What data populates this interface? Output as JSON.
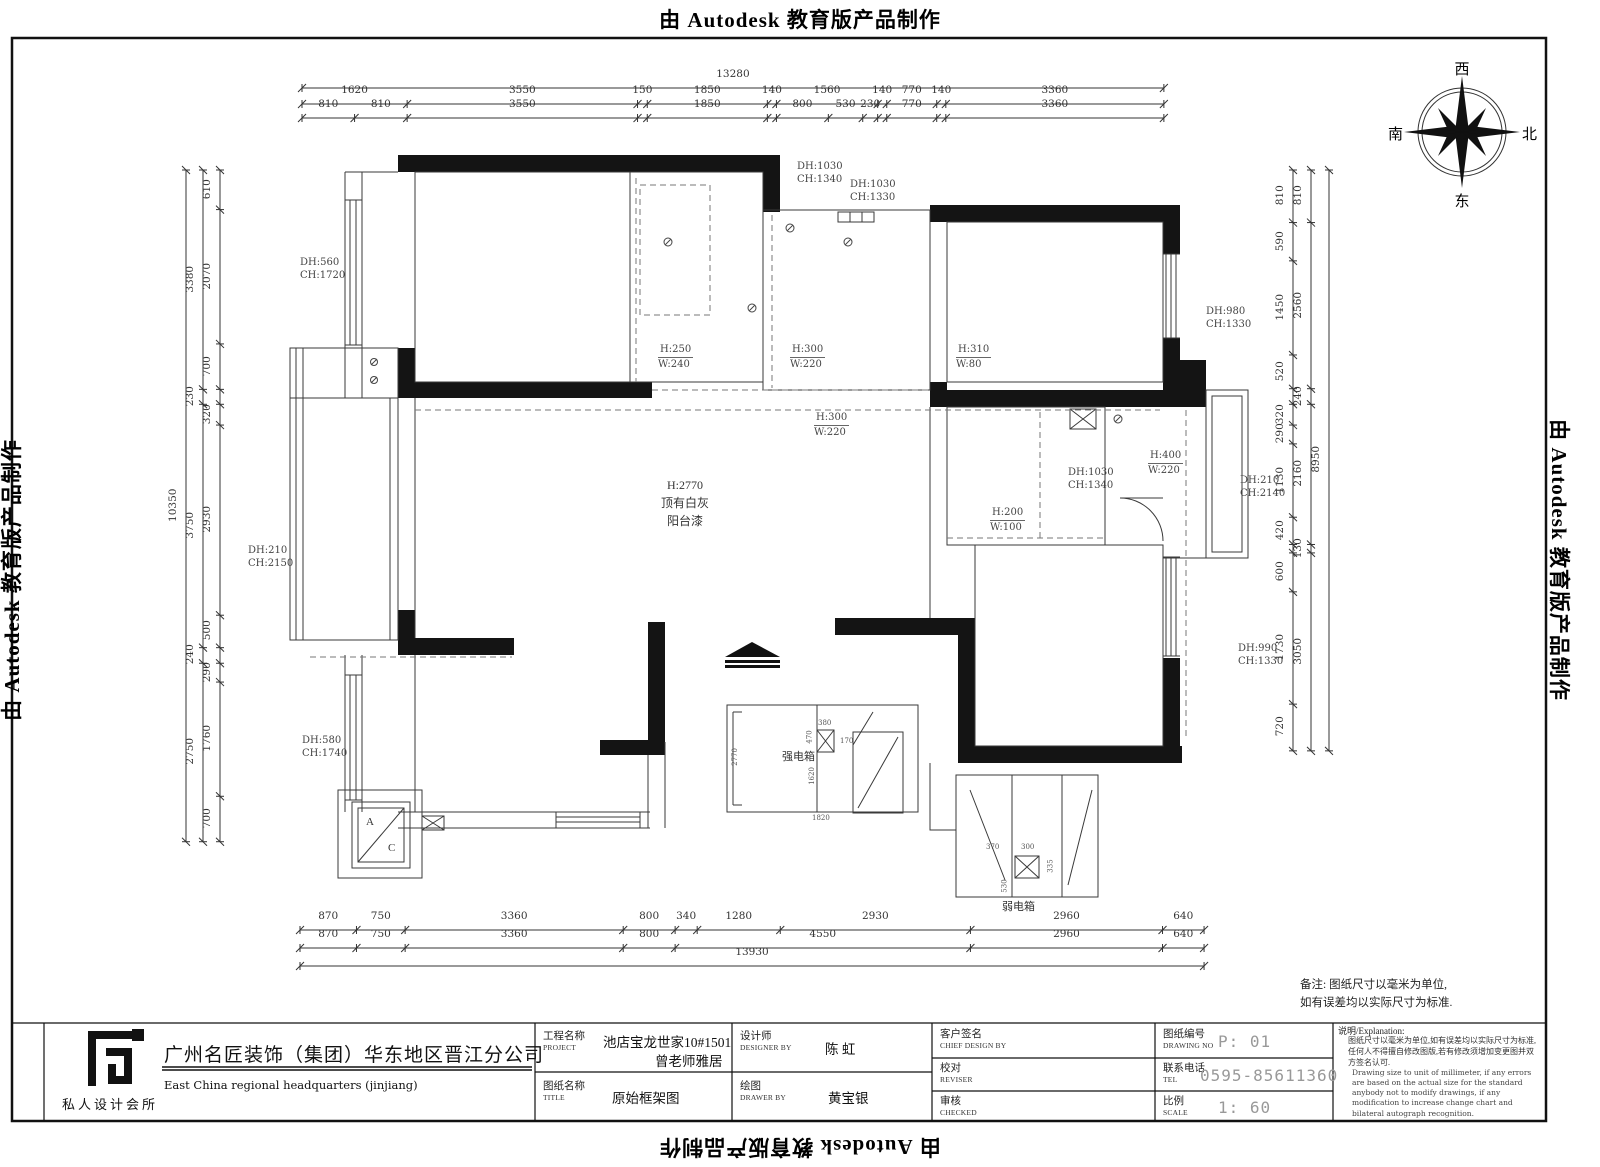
{
  "edge": {
    "top": "由 Autodesk 教育版产品制作",
    "bottom": "由 Autodesk 教育版产品制作",
    "left": "由 Autodesk 教育版产品制作",
    "right": "由 Autodesk 教育版产品制作"
  },
  "compass": {
    "top": "西",
    "left": "南",
    "right": "北",
    "bottom": "东"
  },
  "dims": {
    "top": [
      {
        "segments": [
          13280
        ],
        "labels": [
          "13280"
        ]
      },
      {
        "segments": [
          1620,
          3550,
          150,
          1850,
          140,
          1560,
          140,
          770,
          140,
          3360
        ],
        "labels": [
          "1620",
          "3550",
          "150",
          "1850",
          "140",
          "1560",
          "140",
          "770",
          "140",
          "3360"
        ]
      },
      {
        "segments": [
          810,
          810,
          3550,
          150,
          1850,
          140,
          800,
          530,
          230,
          140,
          770,
          140,
          3360
        ],
        "labels": [
          "810",
          "810",
          "3550",
          "",
          "1850",
          "",
          "800",
          "530",
          "230",
          "",
          "770",
          "",
          "3360"
        ]
      }
    ],
    "bottom": [
      {
        "segments": [
          870,
          750,
          3360,
          800,
          340,
          1280,
          2930,
          2960,
          640
        ],
        "labels": [
          "870",
          "750",
          "3360",
          "800",
          "340",
          "1280",
          "2930",
          "2960",
          "640"
        ]
      },
      {
        "segments": [
          870,
          750,
          3360,
          800,
          4550,
          2960,
          640
        ],
        "labels": [
          "870",
          "750",
          "3360",
          "800",
          "4550",
          "2960",
          "640"
        ]
      },
      {
        "segments": [
          13930
        ],
        "labels": [
          "13930"
        ]
      }
    ],
    "left": [
      {
        "segments": [
          10350
        ],
        "labels": [
          "10350"
        ]
      },
      {
        "segments": [
          3380,
          230,
          3750,
          240,
          2750
        ],
        "labels": [
          "3380",
          "230",
          "3750",
          "240",
          "2750"
        ]
      },
      {
        "segments": [
          610,
          2070,
          700,
          230,
          320,
          2930,
          500,
          240,
          290,
          1760,
          700
        ],
        "labels": [
          "610",
          "2070",
          "700",
          "",
          "320",
          "2930",
          "500",
          "",
          "290",
          "1760",
          "700"
        ]
      }
    ],
    "right": [
      {
        "segments": [
          810,
          590,
          1450,
          520,
          240,
          320,
          290,
          1130,
          420,
          130,
          600,
          1730,
          720
        ],
        "labels": [
          "810",
          "590",
          "1450",
          "520",
          "",
          "320",
          "290",
          "1130",
          "420",
          "",
          "600",
          "1730",
          "720"
        ]
      },
      {
        "segments": [
          810,
          2560,
          240,
          2160,
          130,
          3050
        ],
        "labels": [
          "810",
          "2560",
          "240",
          "2160",
          "130",
          "3050"
        ]
      },
      {
        "segments": [
          8950
        ],
        "labels": [
          "8950"
        ]
      }
    ]
  },
  "wall_labels": {
    "w_top1": [
      "DH:1030",
      "CH:1340"
    ],
    "w_top2": [
      "DH:1030",
      "CH:1330"
    ],
    "w_left_top": [
      "DH:560",
      "CH:1720"
    ],
    "b1": [
      "H:250",
      "W:240"
    ],
    "b2": [
      "H:300",
      "W:220"
    ],
    "b3": [
      "H:310",
      "W:80"
    ],
    "b4": [
      "H:300",
      "W:220"
    ],
    "w_right_top": [
      "DH:980",
      "CH:1330"
    ],
    "w_mid": [
      "DH:1030",
      "CH:1340"
    ],
    "b5": [
      "H:400",
      "W:220"
    ],
    "w_balc": [
      "DH:210",
      "CH:2140"
    ],
    "b6": [
      "H:200",
      "W:100"
    ],
    "w_left_mid": [
      "DH:210",
      "CH:2150"
    ],
    "w_right_bot": [
      "DH:990",
      "CH:1330"
    ],
    "w_left_bot": [
      "DH:580",
      "CH:1740"
    ]
  },
  "center_label": {
    "l1": "H:2770",
    "l2": "顶有白灰",
    "l3": "阳台漆"
  },
  "boxes": {
    "strong": "强电箱",
    "weak": "弱电箱",
    "ac_a": "A",
    "ac_c": "C"
  },
  "detail_dims": {
    "strong": [
      "380",
      "170",
      "470",
      "1620",
      "2770",
      "1820"
    ],
    "weak": [
      "370",
      "300",
      "335",
      "530"
    ]
  },
  "note": {
    "line1": "备注: 图纸尺寸以毫米为单位,",
    "line2": "如有误差均以实际尺寸为标准."
  },
  "titleblock": {
    "brand": {
      "logo_caption": "私人设计会所",
      "company_cn": "广州名匠装饰（集团）华东地区晋江分公司",
      "company_en": "East China regional headquarters (jinjiang)"
    },
    "project": {
      "label_cn": "工程名称",
      "label_en": "PROJECT",
      "value1": "池店宝龙世家10#1501",
      "value2": "曾老师雅居"
    },
    "title": {
      "label_cn": "图纸名称",
      "label_en": "TITLE",
      "value": "原始框架图"
    },
    "designer": {
      "label_cn": "设计师",
      "label_en": "DESIGNER BY",
      "value": "陈  虹"
    },
    "drawer": {
      "label_cn": "绘图",
      "label_en": "DRAWER BY",
      "value": "黄宝银"
    },
    "client": {
      "label_cn": "客户签名",
      "label_en": "CHIEF DESIGN BY"
    },
    "reviser": {
      "label_cn": "校对",
      "label_en": "REVISER"
    },
    "checker": {
      "label_cn": "审核",
      "label_en": "CHECKED"
    },
    "drawing_no": {
      "label_cn": "图纸编号",
      "label_en": "DRAWING NO",
      "value": "P: 01"
    },
    "tel": {
      "label_cn": "联系电话",
      "label_en": "TEL",
      "value": "0595-85611360"
    },
    "scale": {
      "label_cn": "比例",
      "label_en": "SCALE",
      "value": "1: 60"
    },
    "explanation": {
      "label": "说明/Explanation:",
      "cn": "图纸尺寸以毫米为单位,如有误差均以实际尺寸为标准,任何人不得擅自修改图版,若有修改须增加变更图并双方签名认可.",
      "en": "Drawing size to unit of millimeter, if any errors are based on the actual size for the standard anybody not to modify drawings, if any modification to increase change chart and bilateral autograph recognition."
    }
  }
}
